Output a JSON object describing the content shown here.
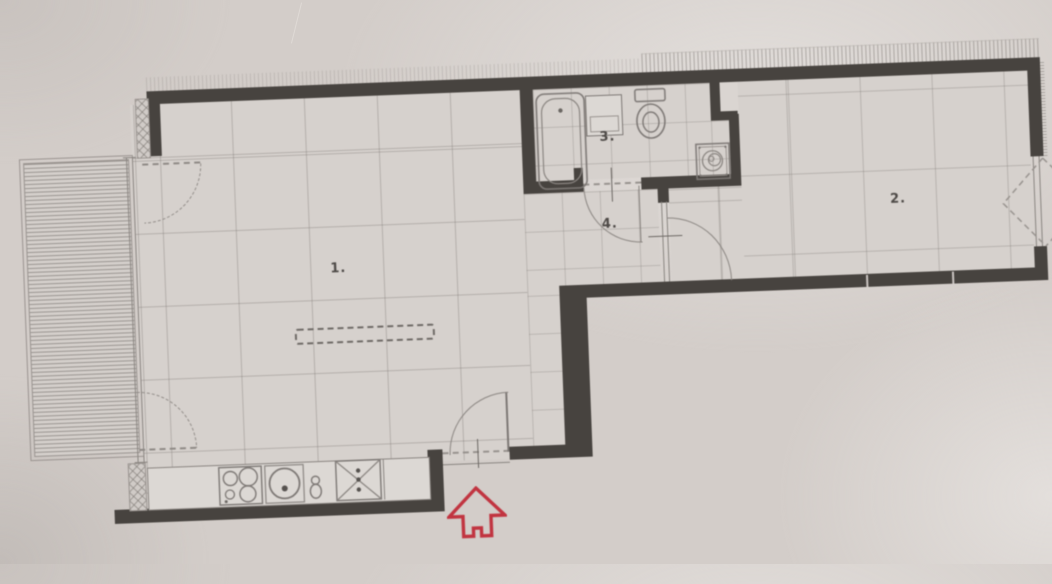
{
  "title": "apartment-floor-plan",
  "rooms": [
    {
      "id": "living-room-kitchen",
      "label": "1."
    },
    {
      "id": "bedroom",
      "label": "2."
    },
    {
      "id": "bathroom",
      "label": "3."
    },
    {
      "id": "hallway",
      "label": "4."
    }
  ],
  "fixtures": [
    "bathtub",
    "vanity-sink",
    "toilet",
    "washing-machine",
    "stove-cooktop",
    "kitchen-sink",
    "faucet",
    "appliance-x-square",
    "kitchen-counter",
    "balcony-decking",
    "wardrobe-dashed-outline"
  ],
  "markers": {
    "entrance_arrow": "red-up-arrow"
  },
  "colors": {
    "paper": "#d3cdc9",
    "wall": "#47433f",
    "line": "#8a8581",
    "floor": "#d6d1cd",
    "accent_red": "#c13440"
  }
}
